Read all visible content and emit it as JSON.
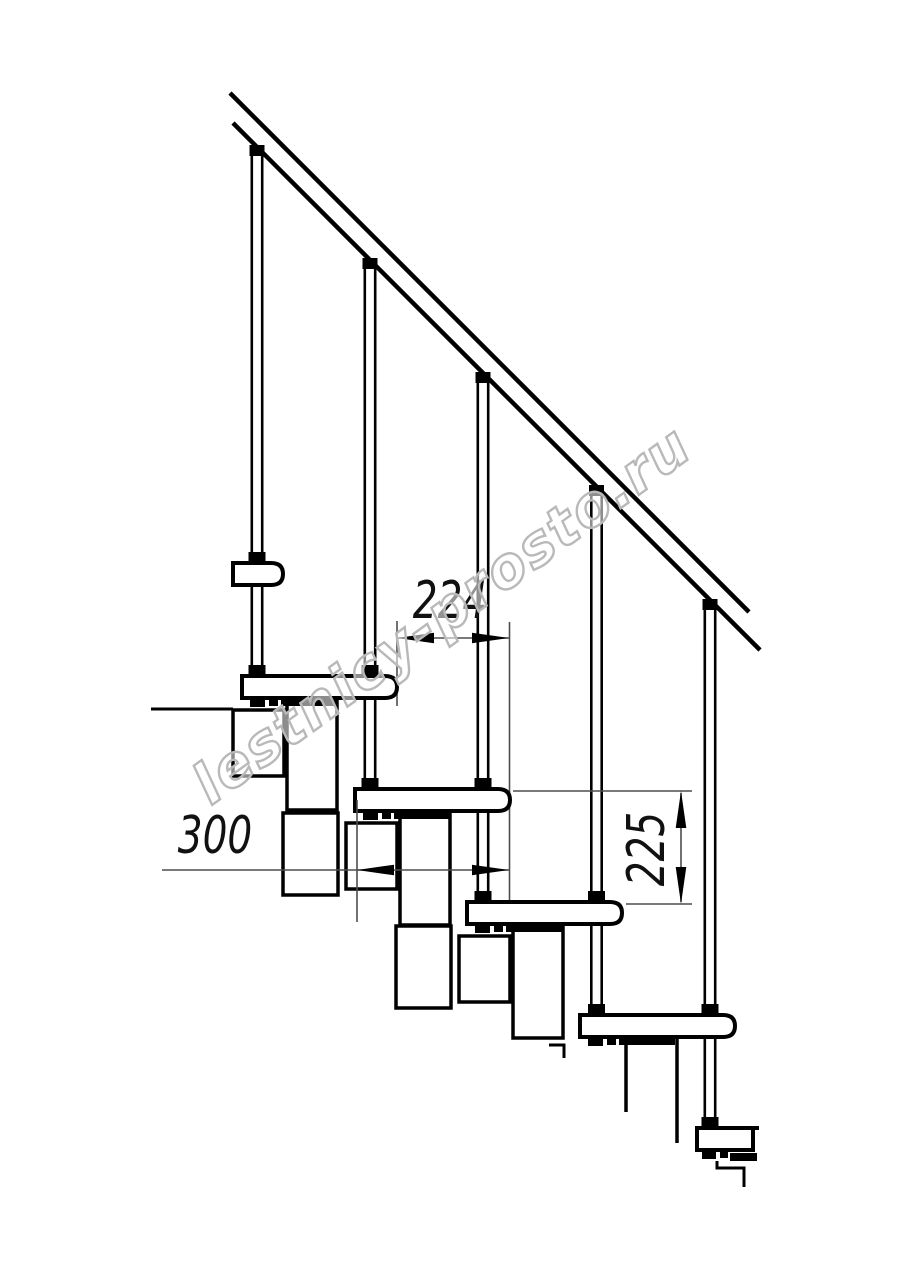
{
  "drawing_title": "Modular staircase side-view technical drawing",
  "canvas": {
    "width": 914,
    "height": 1280,
    "background": "#ffffff",
    "line_color": "#000000",
    "dimension_color": "#4d4d4d"
  },
  "watermark": {
    "text": "lestnicy-prosto.ru",
    "outline_color": "#b9b9b9",
    "angle_deg": -36
  },
  "dimensions": [
    {
      "id": "run",
      "label": "224",
      "orientation": "horizontal",
      "measures": "step run between tread noses"
    },
    {
      "id": "depth",
      "label": "300",
      "orientation": "horizontal",
      "measures": "tread depth"
    },
    {
      "id": "rise",
      "label": "225",
      "orientation": "vertical",
      "measures": "step rise between tread tops"
    }
  ],
  "structure": {
    "handrail": "inclined at ~45 deg from top-left to mid-right",
    "balusters_count": 5,
    "treads_visible": 6,
    "treads_note": "topmost and bottommost treads are cut by drawing crop",
    "supports": "stacked rectangular modules under each tread"
  }
}
